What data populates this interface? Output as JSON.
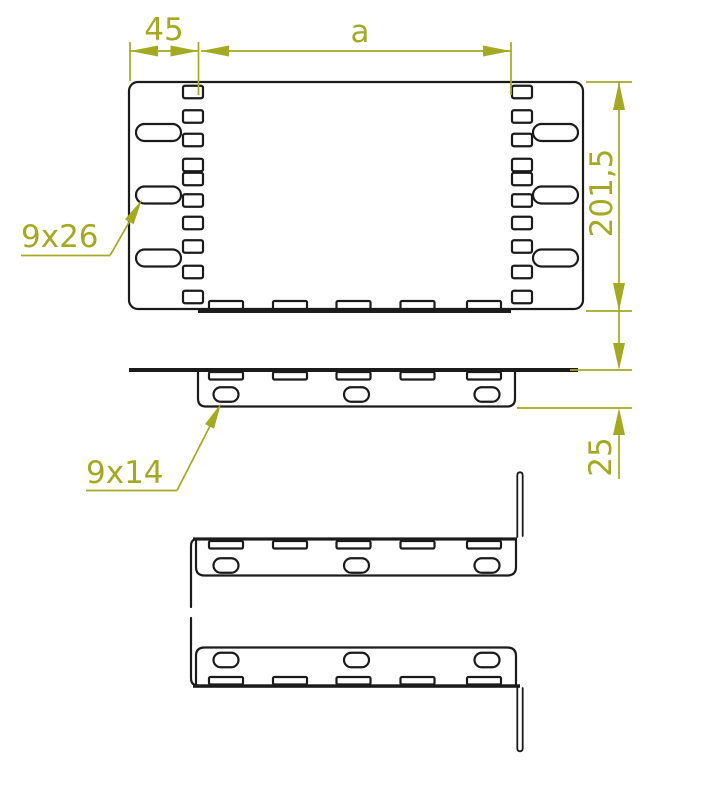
{
  "drawing": {
    "dimensions": {
      "offset_width": "45",
      "variable_width": "a",
      "total_height": "201,5",
      "flange_height": "25"
    },
    "hole_labels": {
      "plate_slot": "9x26",
      "flange_slot": "9x14"
    },
    "colors": {
      "line": "#1b1b1b",
      "dimension": "#a3aa22",
      "background": "#ffffff"
    }
  }
}
